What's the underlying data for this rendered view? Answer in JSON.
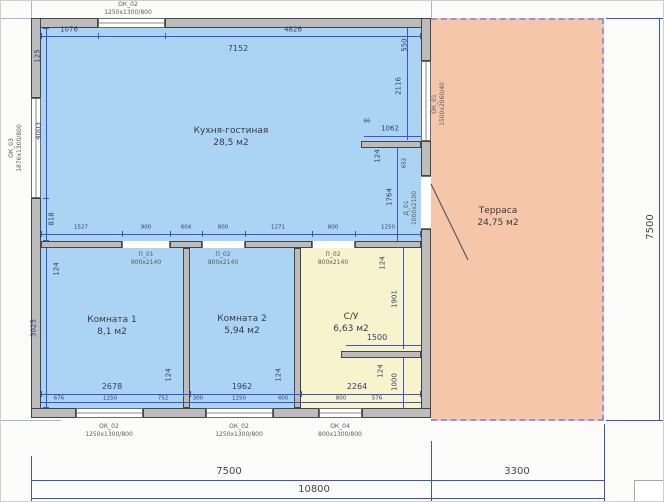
{
  "plan": {
    "title": "floor-plan",
    "colors": {
      "room_fill": "#abd3f4",
      "bath_fill": "#f7f3cd",
      "terrace_fill": "#f6c6ab",
      "wall_fill": "#bcbcbc",
      "dim_line": "#3b55c4"
    },
    "rooms": {
      "kitchen": {
        "name": "Кухня-гостиная",
        "area": "28,5 м2"
      },
      "room1": {
        "name": "Комната 1",
        "area": "8,1 м2"
      },
      "room2": {
        "name": "Комната 2",
        "area": "5,94 м2"
      },
      "bathroom": {
        "name": "С/У",
        "area": "6,63 м2"
      },
      "terrace": {
        "name": "Терраса",
        "area": "24,75 м2"
      }
    },
    "openings": {
      "top_window": {
        "tag": "ОК_02",
        "size": "1250х1300/800"
      },
      "left_window": {
        "tag": "ОК_03",
        "size": "1876х1300/800"
      },
      "right_window": {
        "tag": "ОК_01",
        "size": "1500х2060/40"
      },
      "terrace_door": {
        "tag": "Д_01",
        "size": "1000х2100"
      },
      "bottom_window1": {
        "tag": "ОК_02",
        "size": "1250х1300/800"
      },
      "bottom_window2": {
        "tag": "ОК_02",
        "size": "1250х1300/800"
      },
      "bottom_window3": {
        "tag": "ОК_04",
        "size": "800х1300/800"
      },
      "door_room1": {
        "tag": "П_01",
        "size": "900х2140"
      },
      "door_room2": {
        "tag": "П_02",
        "size": "800х2140"
      },
      "door_su": {
        "tag": "П_02",
        "size": "800х2140"
      }
    },
    "dims": {
      "wall": "124",
      "building_width": "7500",
      "building_height": "7500",
      "terrace_width": "3300",
      "total_width": "10800",
      "kitchen_width": "7152",
      "top_left": "1076",
      "top_right": "4826",
      "left_corner": "125",
      "left_height": "4003",
      "left_low": "818",
      "rooms_height": "3025",
      "right_top": "550",
      "right_upper": "2116",
      "right_tiny": "66",
      "stub_len": "1062",
      "right_mid": "652",
      "stub_down": "1764",
      "mid_row": [
        "1527",
        "900",
        "604",
        "800",
        "1271",
        "800",
        "1250"
      ],
      "room1_width": "2678",
      "room2_width": "1962",
      "su_width": "2264",
      "r1_parts": [
        "676",
        "1250",
        "752"
      ],
      "r2_parts": [
        "300",
        "1250",
        "400"
      ],
      "su_parts": [
        "800",
        "576"
      ],
      "su_upper": "1901",
      "su_stub": "1500",
      "su_lower": "1000"
    }
  }
}
